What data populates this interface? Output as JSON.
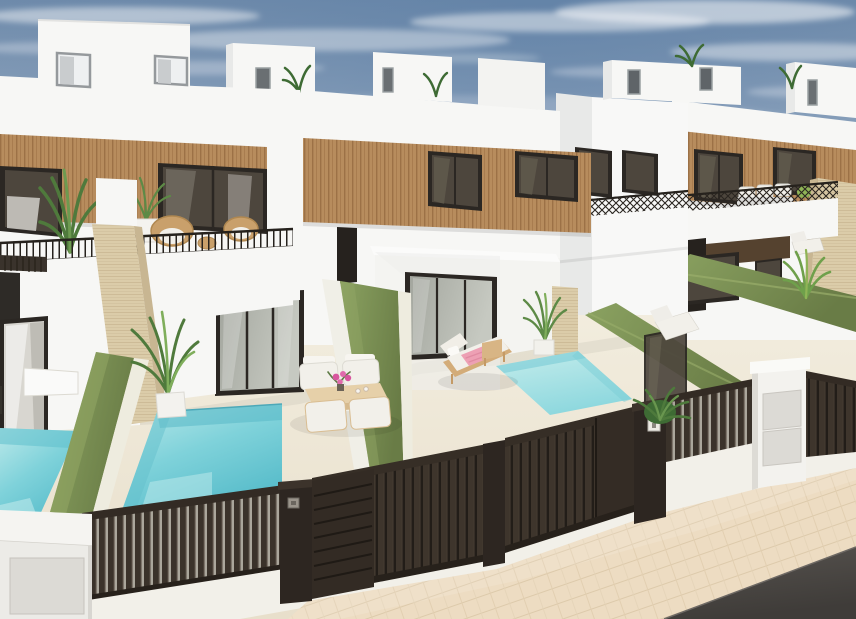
{
  "meta": {
    "title": "New-build terraced villas with private pools — 3D exterior render",
    "type": "3d-architectural-render"
  },
  "scene": {
    "caption": "Row of modern white two-storey townhouses with wood-slat facade panels, rooftop stair bulkheads with plants, balconies with thin dark railings, private yards with turquoise plunge pools, green hedge privacy walls, travertine pillars, outdoor dining set and sun loungers with pink towels, dark brown slatted street fences and sliding gates, beige paver sidewalk and asphalt road under a hazy blue sky"
  },
  "colors": {
    "sky_top": "#6f8bab",
    "sky_mid": "#93a8c0",
    "sky_low": "#b8c4d1",
    "sky_horizon": "#dde2e4",
    "cloud": "#f4f6f8",
    "wall": "#f7f7f5",
    "wall_shade": "#e8e9e8",
    "wall_dark": "#d9dbdb",
    "wood": "#b78c5d",
    "wood_line": "#9c7146",
    "frame": "#2b2723",
    "glass_dark": "#4d463d",
    "glass_streak": "#76705f",
    "glass_door": "#a3a69e",
    "glass_door_light": "#c6c9c1",
    "hedge_light": "#8ba261",
    "hedge_dark": "#697c46",
    "hedge_edge": "#9aae6b",
    "pool_light": "#bce9ea",
    "pool_mid": "#7fd2da",
    "pool_deep": "#57bcca",
    "patio": "#f3eee0",
    "patio_deep": "#e8dfcb",
    "curb": "#f2f0e9",
    "fence_bar": "#3a322a",
    "fence_gap": "#aaa69b",
    "gate_bar": "#3e352c",
    "gate_gap": "#221d18",
    "post": "#2d2621",
    "soffit_wood": "#55422f",
    "travertine": "#dbcca9",
    "travertine_line": "#cdbb97",
    "travertine_shade": "#c8b692",
    "sidewalk": "#eddcc2",
    "sidewalk_line": "#ddcaab",
    "road": "#57534f",
    "road_deep": "#3f3c39",
    "railing": "#26221d",
    "rattan": "#c9a06b",
    "cushion": "#f2f0ea",
    "table_wood": "#e6d0a9",
    "table_edge": "#d6ba8e",
    "towel": "#eda0b4",
    "flower": "#d8569e",
    "plant": "#5d8a46",
    "plant_dark": "#3e6b34",
    "plant_bright": "#8fb456",
    "cabinet": "#ecebe7",
    "panel": "#dcdad5",
    "keypad": "#9b958c",
    "plate": "#eceae4"
  }
}
